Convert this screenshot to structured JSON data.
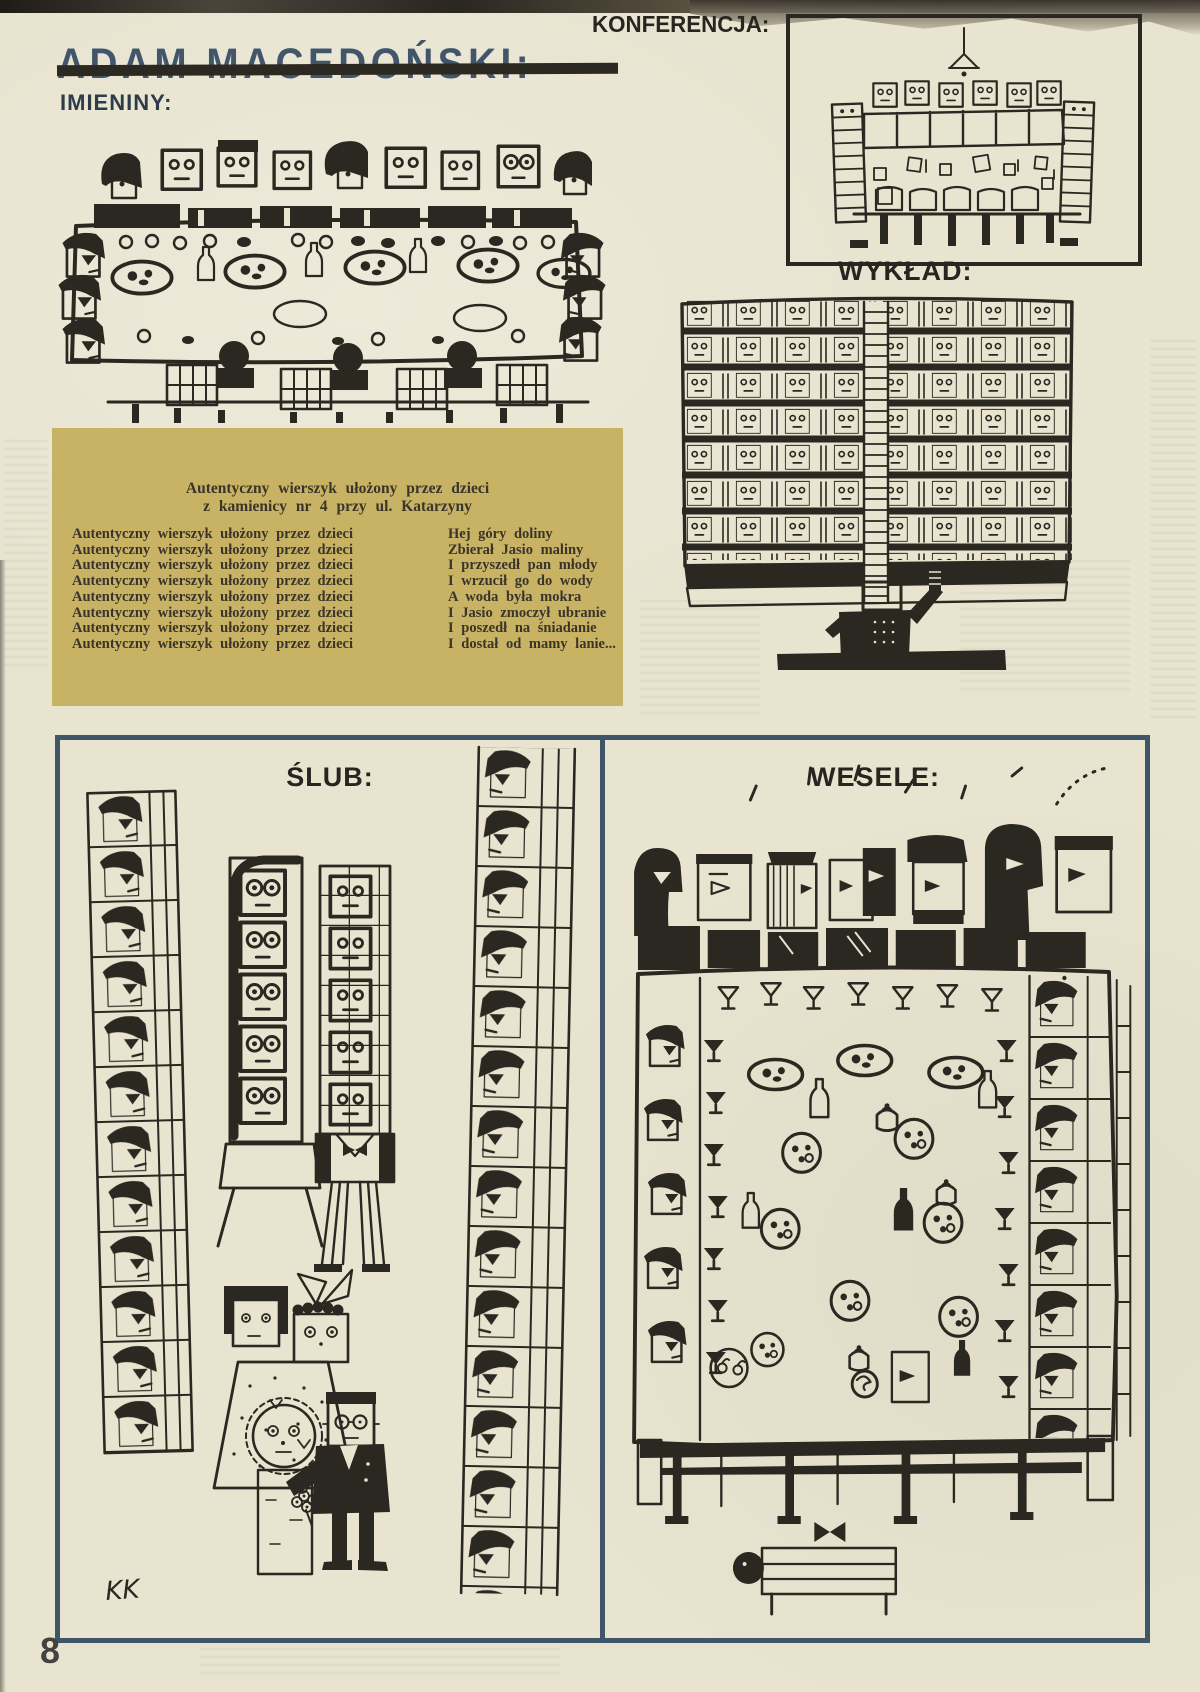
{
  "page": {
    "artist_title": "ADAM MACEDOŃSKI:",
    "page_number": "8",
    "signature": "KK"
  },
  "labels": {
    "imieniny": "IMIENINY:",
    "konferencja": "KONFERENCJA:",
    "wyklad": "WYKŁAD:",
    "slub": "ŚLUB:",
    "wesele": "WESELE:"
  },
  "poem_box": {
    "title_line1": "Autentyczny wierszyk ułożony przez dzieci",
    "title_line2": "z kamienicy nr 4 przy ul. Katarzyny",
    "rows": [
      {
        "left": "Autentyczny wierszyk ułożony przez dzieci",
        "right": "Hej góry doliny"
      },
      {
        "left": "Autentyczny wierszyk ułożony przez dzieci",
        "right": "Zbierał Jasio maliny"
      },
      {
        "left": "Autentyczny wierszyk ułożony przez dzieci",
        "right": "I przyszedł pan młody"
      },
      {
        "left": "Autentyczny wierszyk ułożony przez dzieci",
        "right": "I wrzucił go do wody"
      },
      {
        "left": "Autentyczny wierszyk ułożony przez dzieci",
        "right": "A woda była mokra"
      },
      {
        "left": "Autentyczny wierszyk ułożony przez dzieci",
        "right": "I Jasio zmoczył ubranie"
      },
      {
        "left": "Autentyczny wierszyk ułożony przez dzieci",
        "right": "I poszedł na śniadanie"
      },
      {
        "left": "Autentyczny wierszyk ułożony przez dzieci",
        "right": "I dostał od mamy lanie..."
      }
    ],
    "bg_color": "#c8b263"
  },
  "colors": {
    "paper": "#e8e4d0",
    "ink": "#2b2721",
    "title_blue": "#42566b",
    "panel_border": "#3f5568",
    "gold": "#c8b263"
  }
}
